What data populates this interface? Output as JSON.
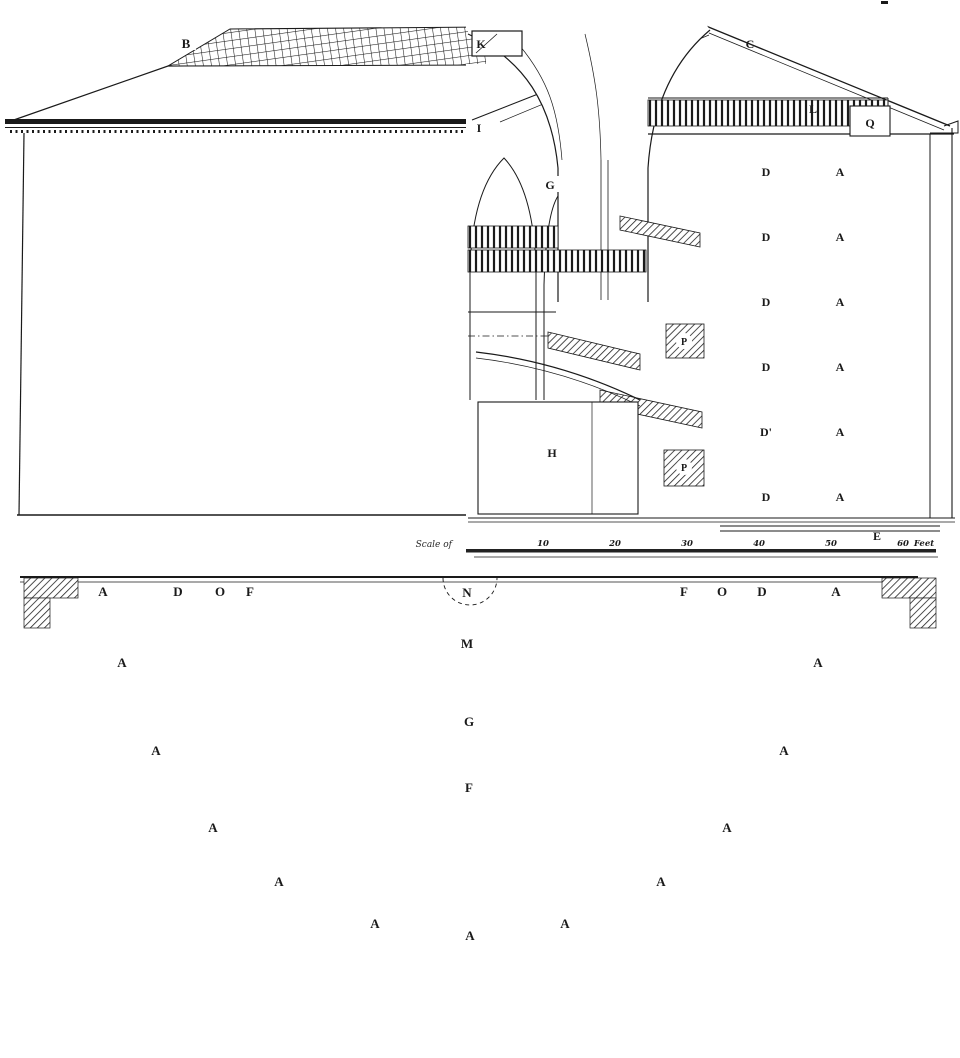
{
  "figure": {
    "ink": "#1a1a1a",
    "paper": "#ffffff"
  },
  "elevation": {
    "roof_label": "B"
  },
  "section": {
    "labels": {
      "k": "K",
      "c": "C",
      "i": "I",
      "l": "L",
      "q": "Q",
      "g": "G",
      "h": "H",
      "e": "E"
    },
    "stairs": [
      "P",
      "P"
    ],
    "floors": [
      {
        "d": "D",
        "a": "A"
      },
      {
        "d": "D",
        "a": "A"
      },
      {
        "d": "D",
        "a": "A"
      },
      {
        "d": "D",
        "a": "A"
      },
      {
        "d": "D'",
        "a": "A"
      },
      {
        "d": "D",
        "a": "A"
      }
    ],
    "scale": {
      "caption": "Scale of",
      "ticks": [
        "10",
        "20",
        "30",
        "40",
        "50",
        "60"
      ],
      "unit": "Feet"
    }
  },
  "plan": {
    "ring_left": [
      "A",
      "D",
      "O",
      "F"
    ],
    "ring_right": [
      "F",
      "O",
      "D",
      "A"
    ],
    "center": {
      "n": "N",
      "m": "M",
      "g": "G",
      "f": "F"
    },
    "cells": [
      "A",
      "A",
      "A",
      "A",
      "A",
      "A",
      "A",
      "A",
      "A",
      "A",
      "A"
    ]
  }
}
